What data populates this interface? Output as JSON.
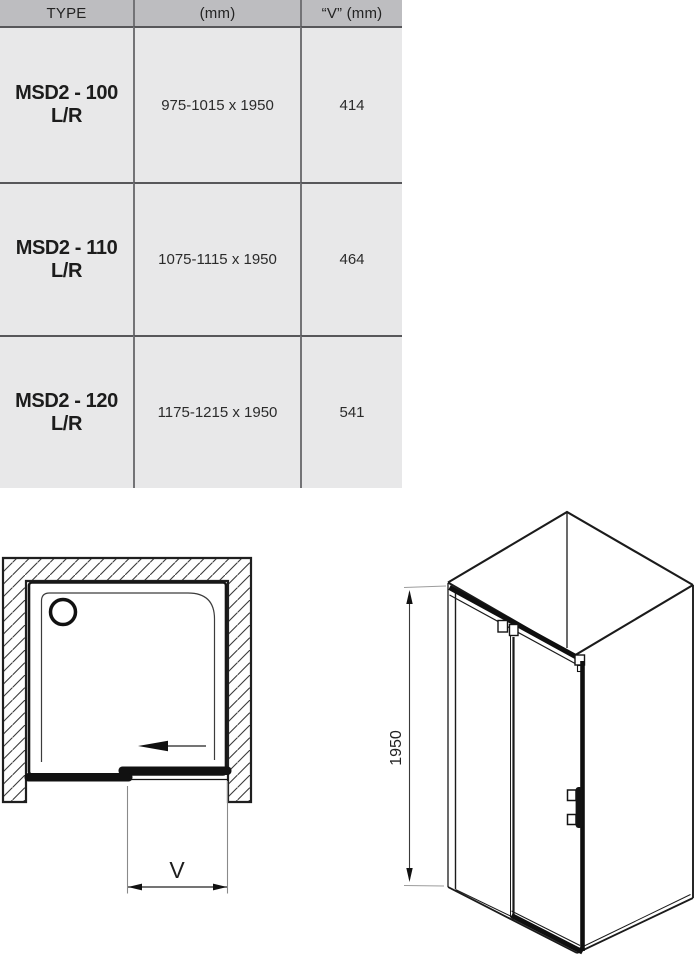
{
  "table": {
    "headers": [
      {
        "label": "TYPE"
      },
      {
        "label": "(mm)"
      },
      {
        "label": "“V” (mm)"
      }
    ],
    "rows": [
      {
        "type": "MSD2 - 100 L/R",
        "dimensions_mm": "975-1015 x 1950",
        "v_mm": "414"
      },
      {
        "type": "MSD2 - 110 L/R",
        "dimensions_mm": "1075-1115 x 1950",
        "v_mm": "464"
      },
      {
        "type": "MSD2 - 120 L/R",
        "dimensions_mm": "1175-1215 x 1950",
        "v_mm": "541"
      }
    ],
    "colors": {
      "header_bg": "#bdbdc0",
      "cell_bg": "#e8e8e9",
      "row_line": "#57575a",
      "col_line": "#737376"
    }
  },
  "diagrams": {
    "top_view": {
      "width_label": "V"
    },
    "iso_view": {
      "height_label": "1950"
    },
    "line_color": "#1b1b1b"
  }
}
